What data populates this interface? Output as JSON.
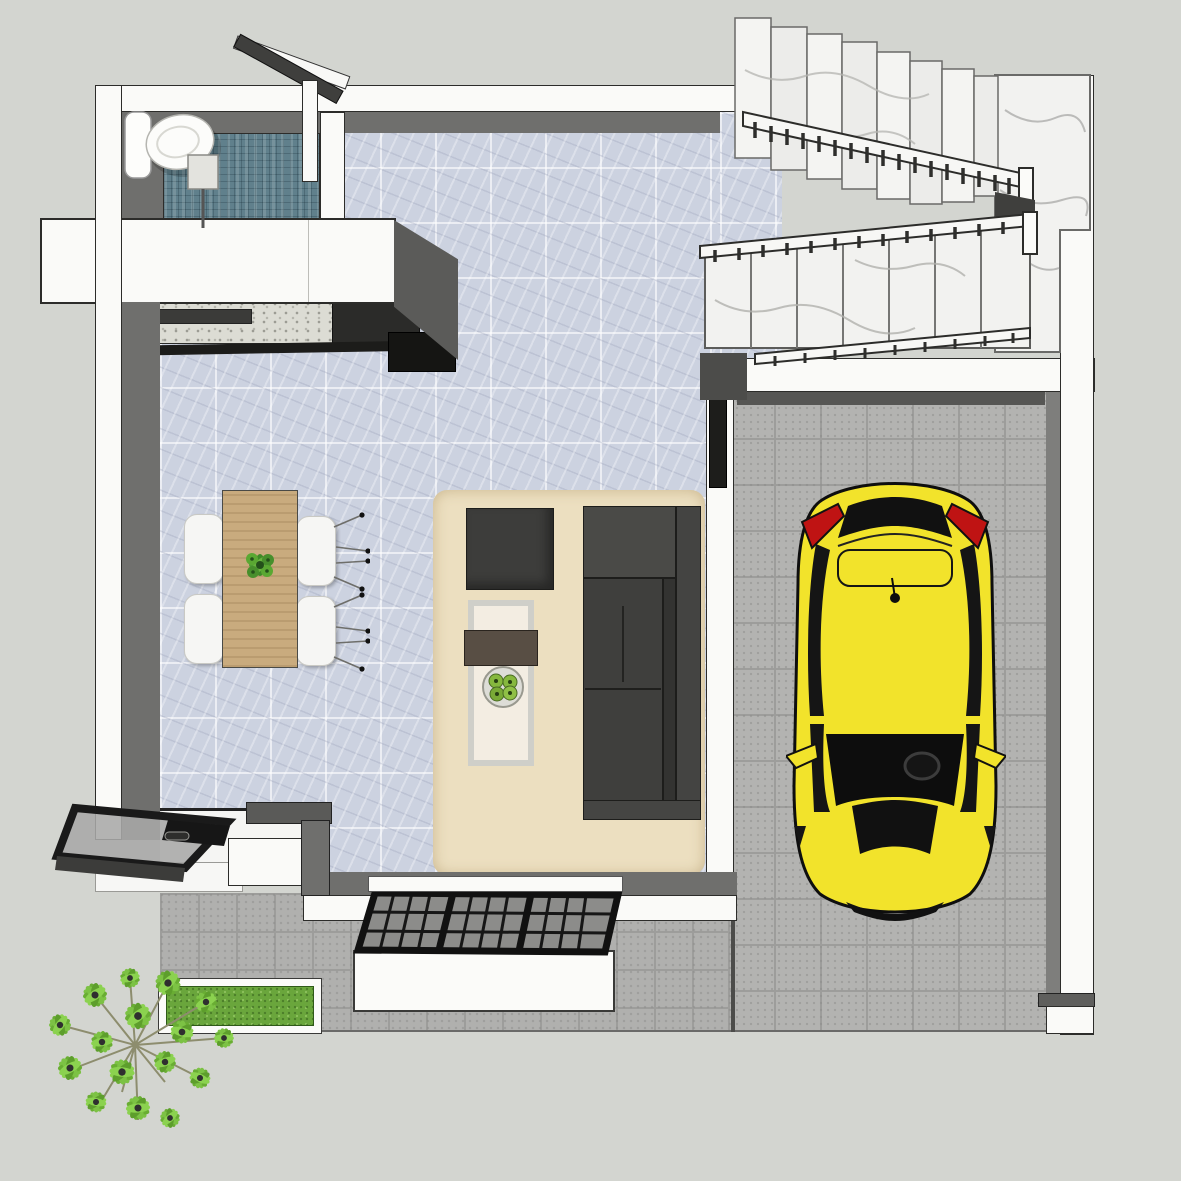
{
  "scene": {
    "description": "3d-top-down-floor-plan-render",
    "rooms": [
      "bathroom",
      "kitchen",
      "dining-area",
      "living-area",
      "staircase",
      "garage",
      "entry-porch"
    ]
  },
  "colors": {
    "exterior_ground": "#d3d5d0",
    "wall_white": "#fafaf8",
    "wall_inner_face": "#6f6f6d",
    "wall_cap_dark": "#5a5a58",
    "marble_floor": "#ccd2e0",
    "bathroom_mosaic": "#60808c",
    "terrazzo_counter": "#dcdcd4",
    "counter_dark": "#2b2b29",
    "stove_black": "#151513",
    "paver_gray": "#b3b3b1",
    "porch_paver": "#b0b0ae",
    "rug_beige": "#ecdfc0",
    "sofa_gray": "#3f3f3d",
    "sofa_gray_light": "#4a4a47",
    "ottoman_gray": "#3d3d3b",
    "coffee_tray_brown": "#584e44",
    "wood_table": "#c9ab7e",
    "chair_white": "#f6f6f4",
    "plant_green": "#4f9e33",
    "fruit_green": "#86b83e",
    "car_yellow": "#f2e32b",
    "car_glass_black": "#111111",
    "car_taillight_red": "#bf1313",
    "stair_marble": "#f2f2f0",
    "railing_white": "#f7f7f5",
    "grass_green": "#6aa63c",
    "tree_green": "#7cc244",
    "canopy_black": "#1a1a1a",
    "canopy_glass": "#a9a9a7",
    "trellis_glass": "#8c8c8a",
    "door_panel_dark": "#1d1d1b"
  },
  "objects": {
    "bathroom": {
      "fixtures": [
        "toilet",
        "floor-drain"
      ],
      "door": "swing-door",
      "floor": "teal-mosaic-tile"
    },
    "kitchen": {
      "elements": [
        "white-island-slab",
        "terrazzo-worktop",
        "dark-cooktop-counter",
        "black-appliance-box"
      ]
    },
    "dining": {
      "table": "wood-dining-table",
      "chair_count": 4,
      "centerpiece": "green-plant"
    },
    "living": {
      "sofa": "dark-gray-sectional-sofa",
      "ottoman_count": 1,
      "coffee_table": "framed-coffee-table-with-tray",
      "rug": "beige-area-rug",
      "decor": "fruit-plate"
    },
    "garage": {
      "vehicle": "yellow-hatchback-car-top-view",
      "mirror_count": 2,
      "floor": "gray-paver-tile"
    },
    "staircase": {
      "flight_count": 2,
      "railing_count": 3,
      "material": "white-marble"
    },
    "exterior": {
      "tree_count": 1,
      "grass_strip_count": 1,
      "entry_canopy": "black-frame-glass-canopy",
      "trellis_canopy": "black-grid-trellis",
      "planter": "white-planter-box"
    }
  }
}
